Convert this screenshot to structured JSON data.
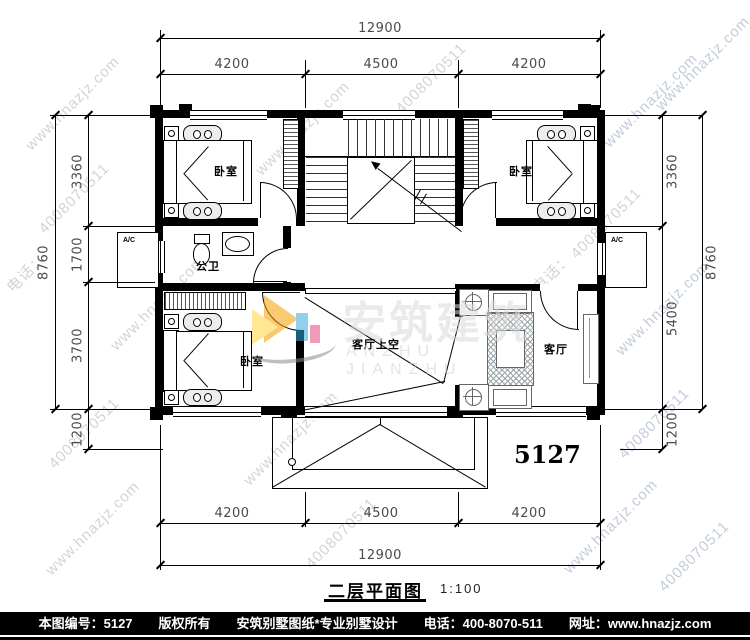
{
  "title": {
    "text": "二层平面图",
    "scale": "1:100"
  },
  "plan_number": "5127",
  "dims": {
    "top": {
      "total": "12900",
      "segments": [
        "4200",
        "4500",
        "4200"
      ]
    },
    "bottom": {
      "total": "12900",
      "segments": [
        "4200",
        "4500",
        "4200"
      ]
    },
    "left": {
      "total": "8760",
      "segments": [
        "3360",
        "1700",
        "3700",
        "1200"
      ]
    },
    "right": {
      "total": "8760",
      "segments": [
        "3360",
        "5400",
        "1200"
      ]
    }
  },
  "rooms": {
    "bedroom_tl": "卧室",
    "bedroom_tr": "卧室",
    "bedroom_bl": "卧室",
    "bath": "公卫",
    "void": "客厅上空",
    "living": "客厅",
    "ac_left": "A/C",
    "ac_right": "A/C"
  },
  "logo": {
    "cn": "安筑建筑",
    "en": "ANZHU JIANZHU"
  },
  "watermark": {
    "site": "www.hnazjz.com",
    "phone": "4008070511",
    "tel": "电话：",
    "web": "网址："
  },
  "footer": {
    "id": "本图编号：5127",
    "copyright": "版权所有",
    "brand": "安筑别墅图纸*专业别墅设计",
    "phone": "电话：400-8070-511",
    "web": "网址：www.hnazjz.com"
  },
  "colors": {
    "wall": "#000000",
    "watermark_gray": "#c6c9cf",
    "watermark_blue": "#b4bed4",
    "footer_bg": "#000000",
    "footer_text": "#ffffff",
    "logo_orange": "#f59f00",
    "logo_yellow": "#ffd43b",
    "logo_blue": "#38a8e0",
    "logo_pink": "#e64980",
    "logo_gray_text": "#d9d9d9"
  }
}
